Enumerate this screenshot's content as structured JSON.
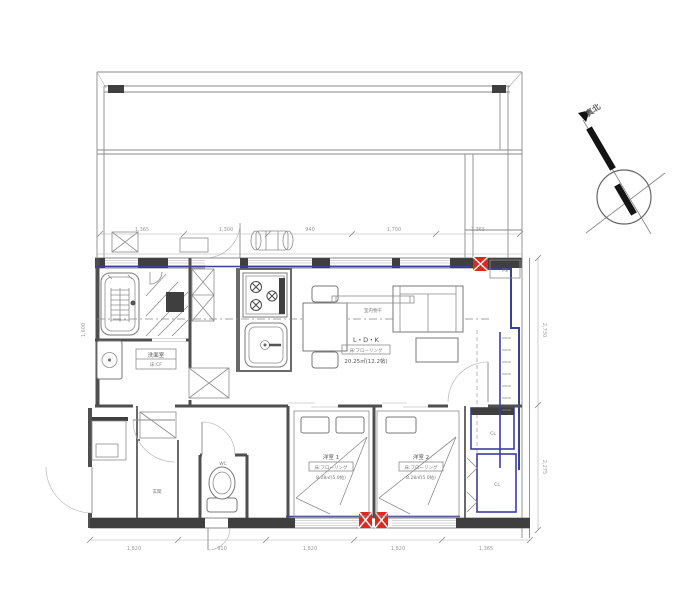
{
  "drawing_type": "apartment-floor-plan",
  "colors": {
    "wall": "#4f4f4f",
    "accent_blue": "#3a3f9e",
    "marker_red": "#d92b20",
    "line_gray": "#8a8a8a",
    "dim_gray": "#9b9b9b"
  },
  "north": {
    "label": "真北"
  },
  "rooms": {
    "ldk": {
      "name": "L・D・K",
      "spec": "床:フローリング",
      "area": "20.25㎡(12.2帖)"
    },
    "bedroom1": {
      "name": "洋室 1",
      "spec": "床:フローリング",
      "area": "8.28㎡(5.0帖)"
    },
    "bedroom2": {
      "name": "洋室 2",
      "spec": "床:フローリング",
      "area": "8.28㎡(5.0帖)"
    },
    "washroom": {
      "name": "洗面室",
      "spec": "床:CF"
    },
    "wc": {
      "name": "WC"
    },
    "genkan": {
      "name": "玄関"
    },
    "closet_upper": {
      "name": "CL"
    },
    "closet_lower": {
      "name": "CL"
    },
    "ps": {
      "name": "PS"
    },
    "drying": {
      "name": "室内物干"
    }
  },
  "dimensions": {
    "top": [
      "1,365",
      "1,300",
      "940",
      "1,700",
      "1,365"
    ],
    "bottom": [
      "1,820",
      "910",
      "1,820",
      "1,820",
      "1,365"
    ],
    "right": [
      "2,730",
      "2,275"
    ],
    "left": [
      "1,600"
    ]
  }
}
